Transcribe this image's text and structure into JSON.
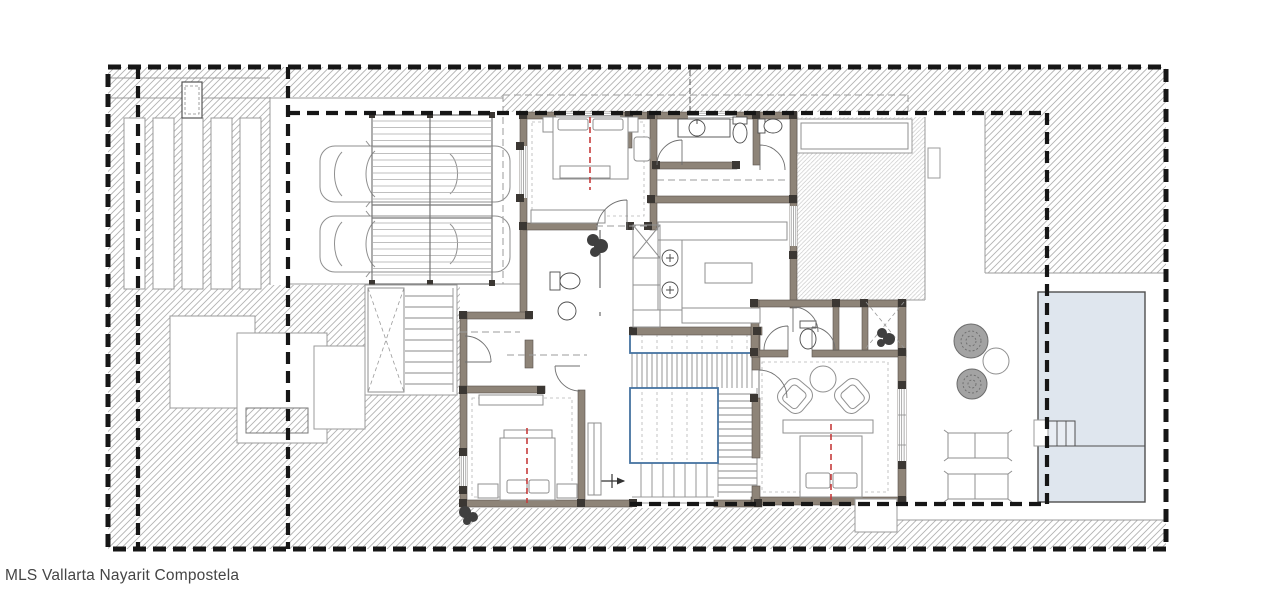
{
  "watermark": {
    "text": "MLS Vallarta Nayarit Compostela"
  },
  "colors": {
    "background": "#ffffff",
    "hatch_line": "#b2b2b2",
    "hatch_line_light": "#cbcbcb",
    "outline": "#4c4c4c",
    "light_outline": "#9b9b9b",
    "boundary_dash": "#161616",
    "wall_fill": "#8e8478",
    "wall_edge": "#57514b",
    "column_fill": "#3b3733",
    "stair_accent": "#4573a1",
    "pool_fill": "#dfe6ee",
    "pool_edge": "#4f4f4f",
    "bed_axis_red": "#c63c3c",
    "furniture_line": "#8f8f8f",
    "vegetation_fill": "#a3a3a3",
    "vegetation_edge": "#6c6c6c",
    "text_color": "#454545"
  },
  "plan": {
    "symbols": [
      "property-boundary-dashed",
      "setback-dashed-line",
      "ground-hatch",
      "louver-screen",
      "utility-box",
      "car",
      "car",
      "garage-pergola-slats",
      "exterior-stair",
      "entry-pads",
      "double-bed",
      "double-bed",
      "double-bed",
      "sofa",
      "tv-panel",
      "vanity-sink",
      "toilet",
      "toilet",
      "toilet",
      "washbasin",
      "kitchen-island",
      "kitchen-sinks",
      "elevator-shaft",
      "stair-core",
      "deck-void",
      "entry-arrow",
      "armchair",
      "armchair",
      "round-table",
      "shower",
      "plant",
      "plant",
      "terrace-hatch",
      "planter",
      "tree",
      "tree",
      "garden-table",
      "sun-lounger",
      "sun-lounger",
      "pool",
      "pool-steps"
    ]
  }
}
